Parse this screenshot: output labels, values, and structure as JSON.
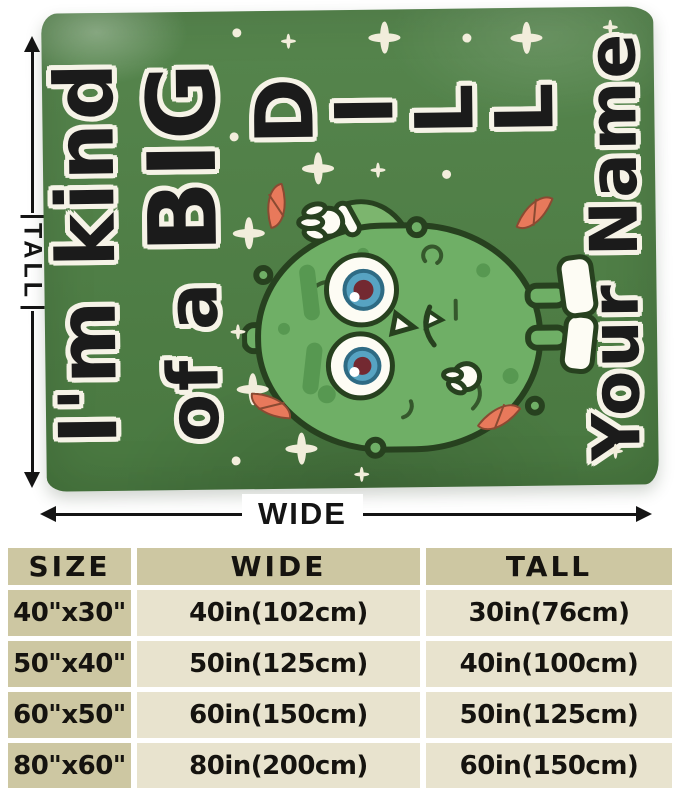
{
  "colors": {
    "blanket-green": "#4d7f44",
    "pickle-green": "#6faf66",
    "pickle-arm": "#7cb56e",
    "pickle-spot": "#579851",
    "pickle-outline": "#27411f",
    "eye-blue": "#57a3c2",
    "cream": "#f2eddb",
    "leaf-salmon": "#e8795b",
    "leaf-outline": "#8a4a32",
    "table-khaki": "#cdc7a2",
    "table-beige": "#e8e3ce",
    "ink": "#15130f"
  },
  "blanket": {
    "design": {
      "line1": "I'm kind",
      "line2_small": "of a ",
      "line2_big": "BIG",
      "dill_letters": [
        "D",
        "I",
        "L",
        "L"
      ],
      "name_text": "Your Name"
    }
  },
  "dimensions": {
    "tall_label": "TALL",
    "wide_label": "WIDE"
  },
  "size_table": {
    "headers": [
      "SIZE",
      "WIDE",
      "TALL"
    ],
    "rows": [
      [
        "40\"x30\"",
        "40in(102cm)",
        "30in(76cm)"
      ],
      [
        "50\"x40\"",
        "50in(125cm)",
        "40in(100cm)"
      ],
      [
        "60\"x50\"",
        "60in(150cm)",
        "50in(125cm)"
      ],
      [
        "80\"x60\"",
        "80in(200cm)",
        "60in(150cm)"
      ]
    ]
  }
}
